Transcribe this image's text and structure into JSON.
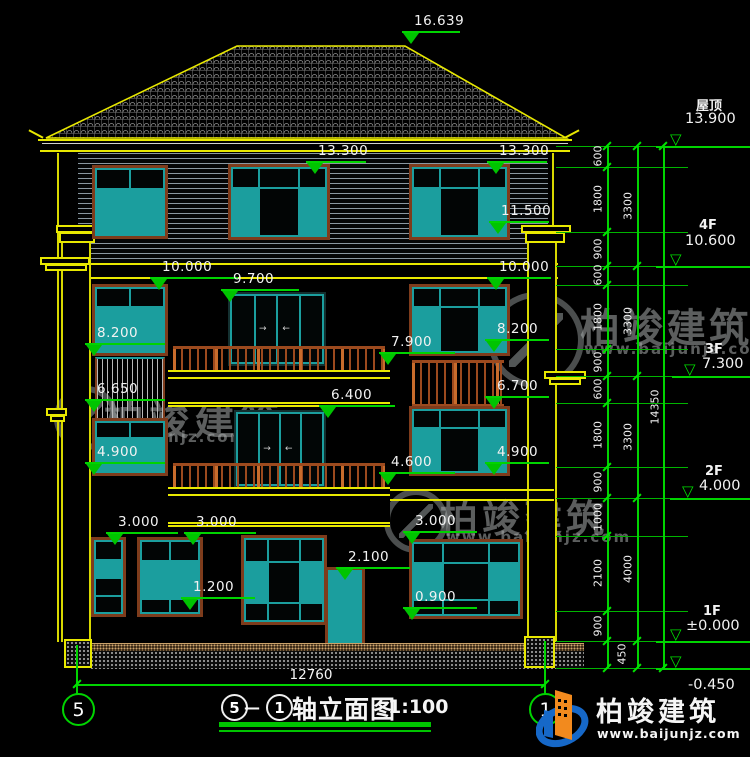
{
  "watermark": {
    "brand": "柏竣建筑",
    "url": "www.baijunjz.com"
  },
  "logo": {
    "brand": "柏竣建筑",
    "url": "www.baijunjz.com"
  },
  "title": {
    "axis_from": "5",
    "axis_to": "1",
    "dash": "—",
    "text": "轴立面图",
    "scale": "1:100"
  },
  "axes": {
    "left": "5",
    "right": "1"
  },
  "overall_width": "12760",
  "overall_height": "14350",
  "icons": {
    "arrow_left": "←",
    "arrow_right": "→",
    "tri_open": "▽"
  },
  "markers": [
    "16.639",
    "13.300",
    "13.300",
    "11.500",
    "10.000",
    "10.000",
    "9.700",
    "8.200",
    "8.200",
    "7.900",
    "6.650",
    "6.400",
    "6.700",
    "4.900",
    "4.900",
    "4.600",
    "3.000",
    "3.000",
    "3.000",
    "2.100",
    "1.200",
    "0.900"
  ],
  "levels": [
    {
      "label": "屋顶",
      "value": "13.900"
    },
    {
      "label": "4F",
      "value": "10.600"
    },
    {
      "label": "3F",
      "value": "7.300"
    },
    {
      "label": "2F",
      "value": "4.000"
    },
    {
      "label": "1F",
      "value": "±0.000"
    },
    {
      "label": "",
      "value": "-0.450"
    }
  ],
  "dims_floor": [
    "600",
    "1800",
    "900",
    "600",
    "1800",
    "900",
    "600",
    "1800",
    "900",
    "1000",
    "2100",
    "900",
    "450"
  ],
  "dims_storey": [
    "3300",
    "3300",
    "3300",
    "4000"
  ]
}
